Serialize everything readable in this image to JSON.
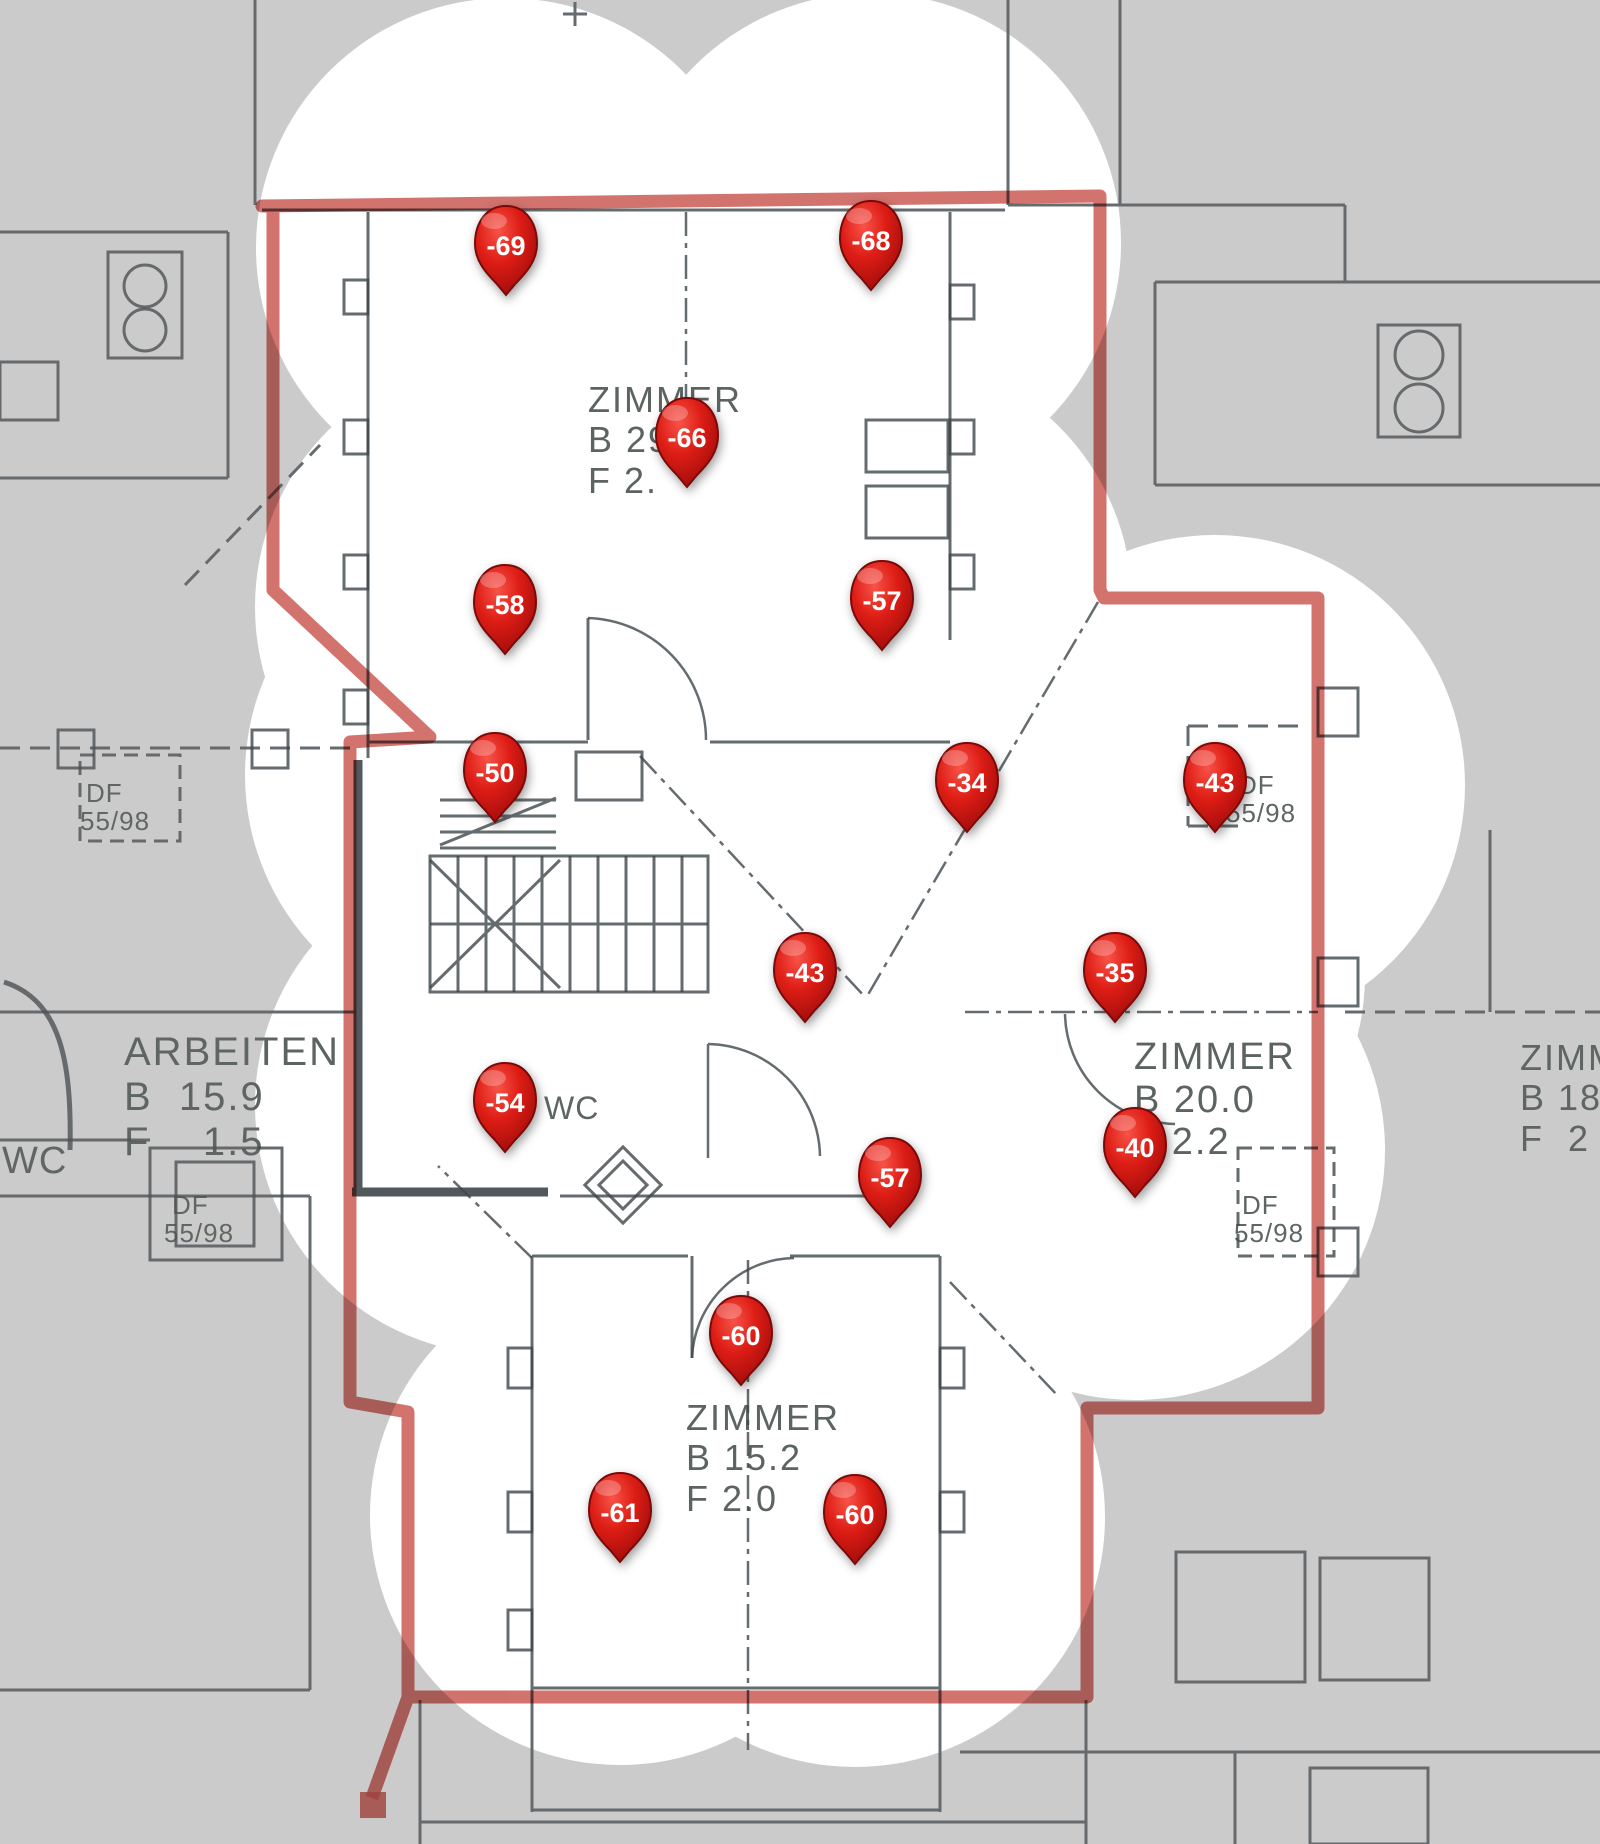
{
  "overlay": {
    "type": "wifi-signal-heatmap",
    "colors": {
      "strong_signal": "#eef75f",
      "medium_signal": "#86f886",
      "weak_signal": "#84f8d8",
      "survey_boundary": "#c0504d",
      "pin": "#d21717"
    }
  },
  "heatmap": {
    "measurements": [
      {
        "value": "-69",
        "x": 506,
        "y": 248
      },
      {
        "value": "-68",
        "x": 871,
        "y": 243
      },
      {
        "value": "-66",
        "x": 687,
        "y": 440
      },
      {
        "value": "-58",
        "x": 505,
        "y": 607
      },
      {
        "value": "-57",
        "x": 882,
        "y": 603
      },
      {
        "value": "-50",
        "x": 495,
        "y": 775
      },
      {
        "value": "-34",
        "x": 967,
        "y": 785
      },
      {
        "value": "-43",
        "x": 1215,
        "y": 785
      },
      {
        "value": "-43",
        "x": 805,
        "y": 975
      },
      {
        "value": "-35",
        "x": 1115,
        "y": 975
      },
      {
        "value": "-54",
        "x": 505,
        "y": 1105
      },
      {
        "value": "-40",
        "x": 1135,
        "y": 1150
      },
      {
        "value": "-57",
        "x": 890,
        "y": 1180
      },
      {
        "value": "-60",
        "x": 741,
        "y": 1338
      },
      {
        "value": "-61",
        "x": 620,
        "y": 1515
      },
      {
        "value": "-60",
        "x": 855,
        "y": 1517
      }
    ]
  },
  "floor_plan": {
    "rooms": [
      {
        "lines": [
          "ZIMMER",
          "B 29",
          "F 2."
        ],
        "x": 588,
        "y": 380,
        "fs": 36
      },
      {
        "lines": [
          "ARBEITEN",
          "B  15.9",
          "F    1.5"
        ],
        "x": 124,
        "y": 1030,
        "fs": 40
      },
      {
        "lines": [
          "ZIMMER",
          "B 20.0",
          "F 2.2"
        ],
        "x": 1134,
        "y": 1036,
        "fs": 38
      },
      {
        "lines": [
          "ZIMMER",
          "B 18",
          "F  2"
        ],
        "x": 1520,
        "y": 1038,
        "fs": 36
      },
      {
        "lines": [
          "ZIMMER",
          "B 15.2",
          "F 2.0"
        ],
        "x": 686,
        "y": 1398,
        "fs": 36
      }
    ],
    "labels": [
      {
        "text": "WC",
        "x": 2,
        "y": 1140,
        "fs": 38
      },
      {
        "text": "WC",
        "x": 544,
        "y": 1090,
        "fs": 32
      },
      {
        "text": "DF",
        "x": 86,
        "y": 778,
        "fs": 26
      },
      {
        "text": "55/98",
        "x": 80,
        "y": 806,
        "fs": 26
      },
      {
        "text": "DF",
        "x": 1238,
        "y": 770,
        "fs": 26
      },
      {
        "text": "55/98",
        "x": 1226,
        "y": 798,
        "fs": 26
      },
      {
        "text": "DF",
        "x": 172,
        "y": 1190,
        "fs": 26
      },
      {
        "text": "55/98",
        "x": 164,
        "y": 1218,
        "fs": 26
      },
      {
        "text": "DF",
        "x": 1242,
        "y": 1190,
        "fs": 26
      },
      {
        "text": "55/98",
        "x": 1234,
        "y": 1218,
        "fs": 26
      }
    ]
  }
}
